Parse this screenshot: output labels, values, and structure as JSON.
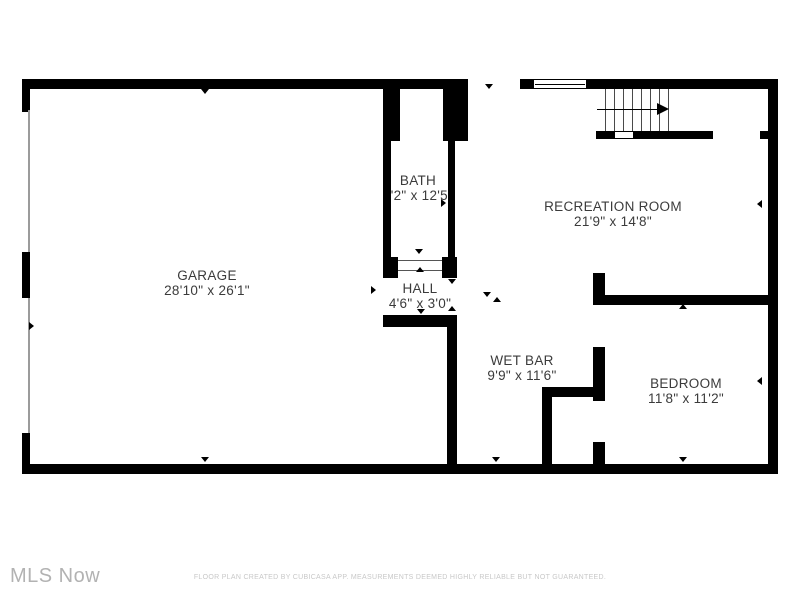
{
  "floorplan": {
    "rooms": [
      {
        "name": "GARAGE",
        "dims": "28'10\" x 26'1\""
      },
      {
        "name": "BATH",
        "dims": "4'2\" x 12'5\""
      },
      {
        "name": "HALL",
        "dims": "4'6\" x 3'0\""
      },
      {
        "name": "RECREATION ROOM",
        "dims": "21'9\" x 14'8\""
      },
      {
        "name": "WET BAR",
        "dims": "9'9\" x 11'6\""
      },
      {
        "name": "BEDROOM",
        "dims": "11'8\" x 11'2\""
      }
    ]
  },
  "footer": {
    "brand": "MLS Now",
    "disclaimer": "FLOOR PLAN CREATED BY CUBICASA APP. MEASUREMENTS DEEMED HIGHLY RELIABLE BUT NOT GUARANTEED."
  },
  "colors": {
    "wall": "#000000",
    "label_text": "#3b3b3b",
    "brand_text": "#b2b2b2",
    "disclaimer_text": "#c8c8c8"
  }
}
